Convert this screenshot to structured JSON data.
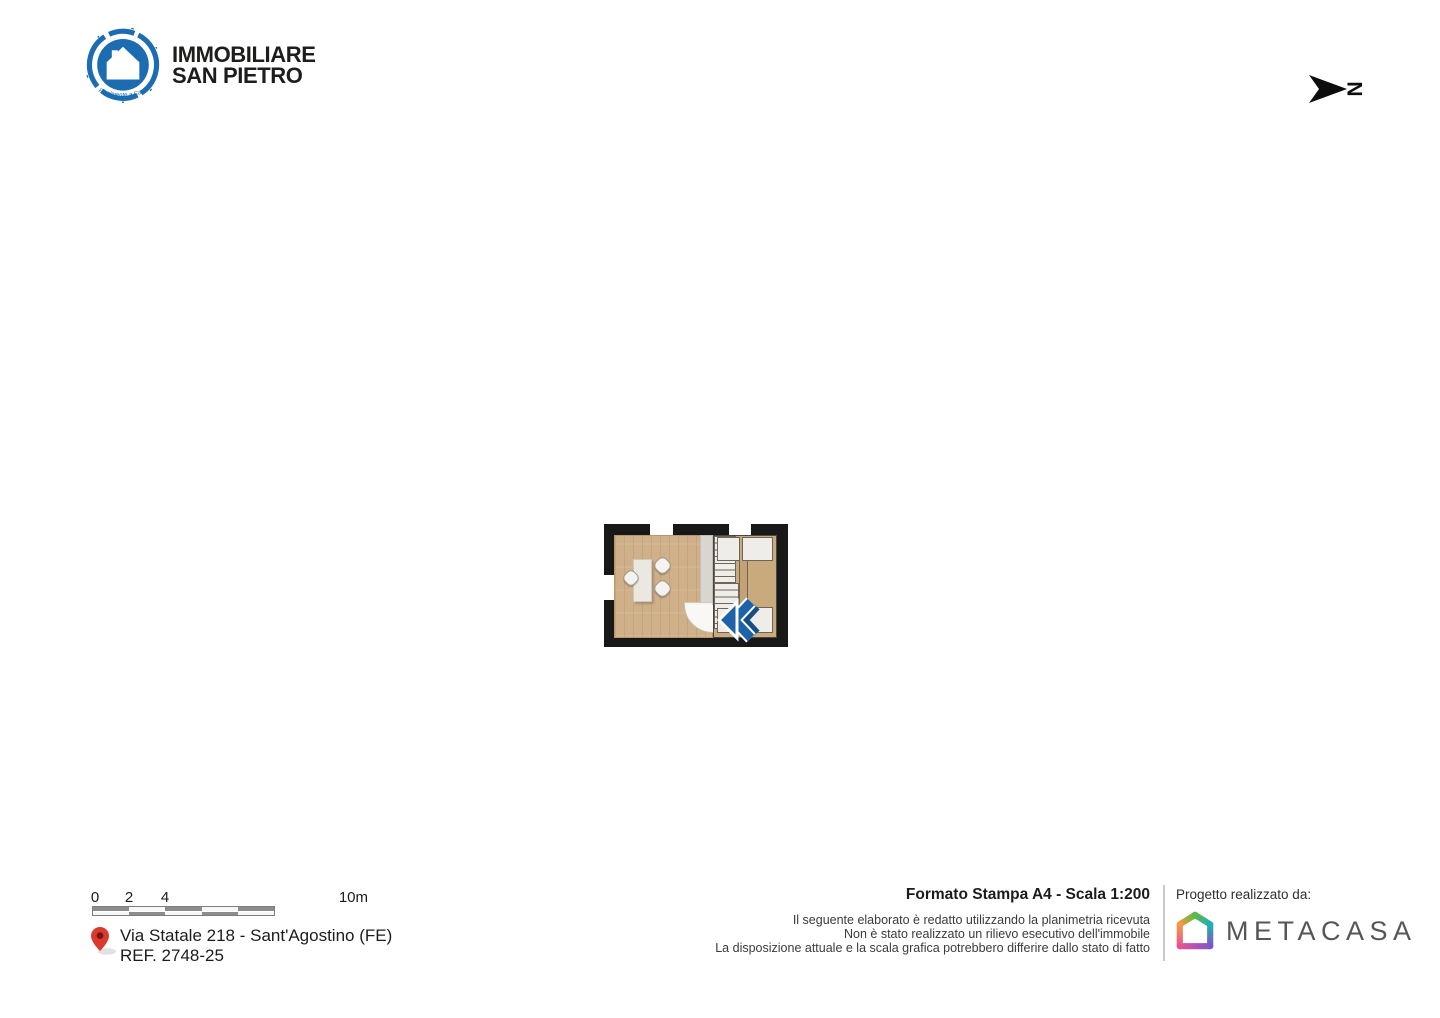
{
  "header": {
    "logo": {
      "line1": "IMMOBILIARE",
      "line2": "SAN PIETRO",
      "tagline": "Finalmente a Casa",
      "brand_color": "#1b6cb1"
    },
    "compass": {
      "label": "N"
    }
  },
  "floor_plan": {
    "colors": {
      "wall": "#181818",
      "wood_floor": "#cfb089",
      "stair_wood": "#c9aa7d",
      "stair_tread": "#efede9",
      "direction_arrow_blue": "#1e63a8"
    }
  },
  "footer": {
    "scale_bar": {
      "tick_labels": [
        "0",
        "2",
        "4",
        "10m"
      ]
    },
    "location": {
      "address": "Via Statale 218 - Sant'Agostino (FE)",
      "reference": "REF. 2748-25",
      "pin_color": "#d83a2e"
    },
    "print_info": {
      "title": "Formato Stampa A4 - Scala 1:200",
      "disclaimer": [
        "Il seguente elaborato è redatto utilizzando la planimetria ricevuta",
        "Non è stato realizzato un rilievo esecutivo dell'immobile",
        "La disposizione attuale e la scala grafica potrebbero differire dallo stato di fatto"
      ]
    },
    "credits": {
      "label": "Progetto realizzato da:",
      "company": "METACASA"
    }
  }
}
